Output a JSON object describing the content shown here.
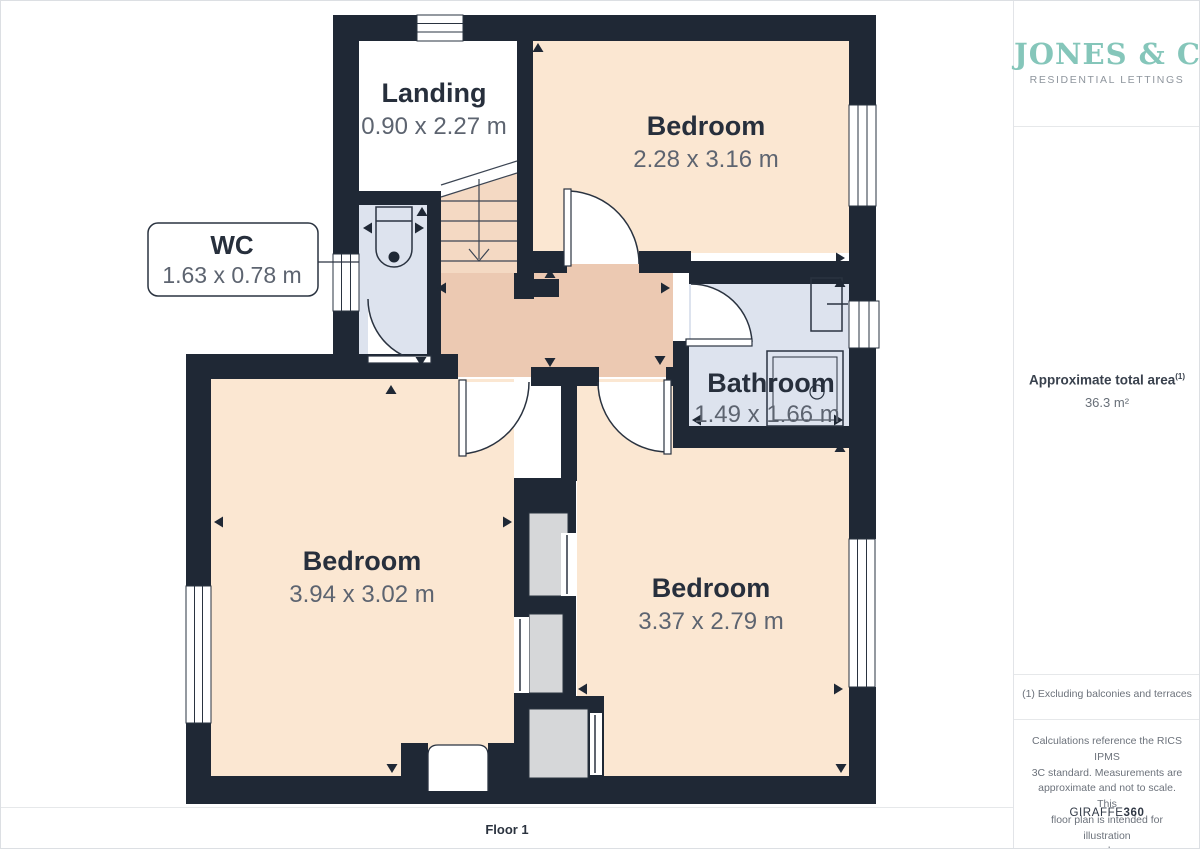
{
  "branding": {
    "name": "JONES & CO",
    "tagline": "RESIDENTIAL LETTINGS",
    "brand_color": "#85c6ba"
  },
  "sidebar": {
    "area_title": "Approximate total area",
    "area_title_sup": "(1)",
    "area_value": "36.3 m²",
    "footnote": "(1) Excluding balconies and terraces",
    "disclaimer_lines": [
      "Calculations reference the RICS IPMS",
      "3C standard. Measurements are",
      "approximate and not to scale. This",
      "floor plan is intended for illustration",
      "only."
    ],
    "provider_name": "GIRAFFE",
    "provider_suffix": "360"
  },
  "plan": {
    "floor_label": "Floor 1",
    "rooms": {
      "landing": {
        "name": "Landing",
        "dims": "0.90 x 2.27 m"
      },
      "bedroom_top": {
        "name": "Bedroom",
        "dims": "2.28 x 3.16 m"
      },
      "wc": {
        "name": "WC",
        "dims": "1.63 x 0.78 m"
      },
      "bathroom": {
        "name": "Bathroom",
        "dims": "1.49 x 1.66 m"
      },
      "bedroom_left": {
        "name": "Bedroom",
        "dims": "3.94 x 3.02 m"
      },
      "bedroom_right": {
        "name": "Bedroom",
        "dims": "3.37 x 2.79 m"
      }
    }
  },
  "colors": {
    "wall": "#1f2835",
    "room_warm": "#fbe7d2",
    "room_hall": "#ecc9b2",
    "room_wet": "#dde3ee",
    "stairs": "#f4d9c3",
    "shaft": "#d6d7d9"
  }
}
